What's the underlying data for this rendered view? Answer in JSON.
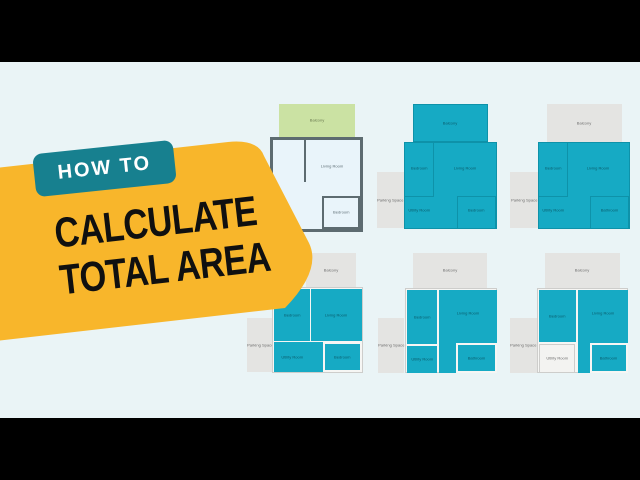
{
  "badge": {
    "label": "HOW TO"
  },
  "headline": {
    "line1": "CALCULATE",
    "line2": "TOTAL AREA"
  },
  "colors": {
    "letterbox": "#000000",
    "background": "#eaf4f6",
    "card_yellow": "#f8b62b",
    "badge_teal": "#17808f",
    "headline_ink": "#101010",
    "room_teal": "#16aac4",
    "room_teal_line": "#0e92a9",
    "teal_label": "#0a5b6b",
    "balcony_green": "#cbe2a3",
    "green_label": "#68794e",
    "gray_fill": "#e4e4e2",
    "gray_label": "#6e6e6e",
    "plan1_wall": "#5d6b70",
    "plan1_floor": "#e9f4fa",
    "plan1_label": "#5f6f76",
    "light_frame": "#cdcdcb",
    "light_floor": "#f6f6f4",
    "white_room": "#f3f3f1"
  },
  "plans": [
    {
      "balcony": "Balcony",
      "living_room": "Living Room",
      "bedroom": "Bedroom"
    },
    {
      "parking": "Parking Space",
      "balcony": "Balcony",
      "bedroom": "Bedroom",
      "living_room": "Living Room",
      "utility_room": "Utility Room",
      "bedroom2": "Bedroom"
    },
    {
      "parking": "Parking Space",
      "balcony": "Balcony",
      "bedroom": "Bedroom",
      "living_room": "Living Room",
      "utility_room": "Utility Room",
      "bathroom": "Bathroom"
    },
    {
      "parking": "Parking Space",
      "balcony": "Balcony",
      "bedroom": "Bedroom",
      "living_room": "Living Room",
      "utility_room": "Utility Room",
      "bedroom2": "Bedroom"
    },
    {
      "parking": "Parking Space",
      "balcony": "Balcony",
      "bedroom": "Bedroom",
      "living_room": "Living Room",
      "utility_room": "Utility Room",
      "bathroom": "Bathroom"
    },
    {
      "parking": "Parking Space",
      "balcony": "Balcony",
      "bedroom": "Bedroom",
      "living_room": "Living Room",
      "utility_room": "Utility Room",
      "bathroom": "Bathroom"
    }
  ]
}
